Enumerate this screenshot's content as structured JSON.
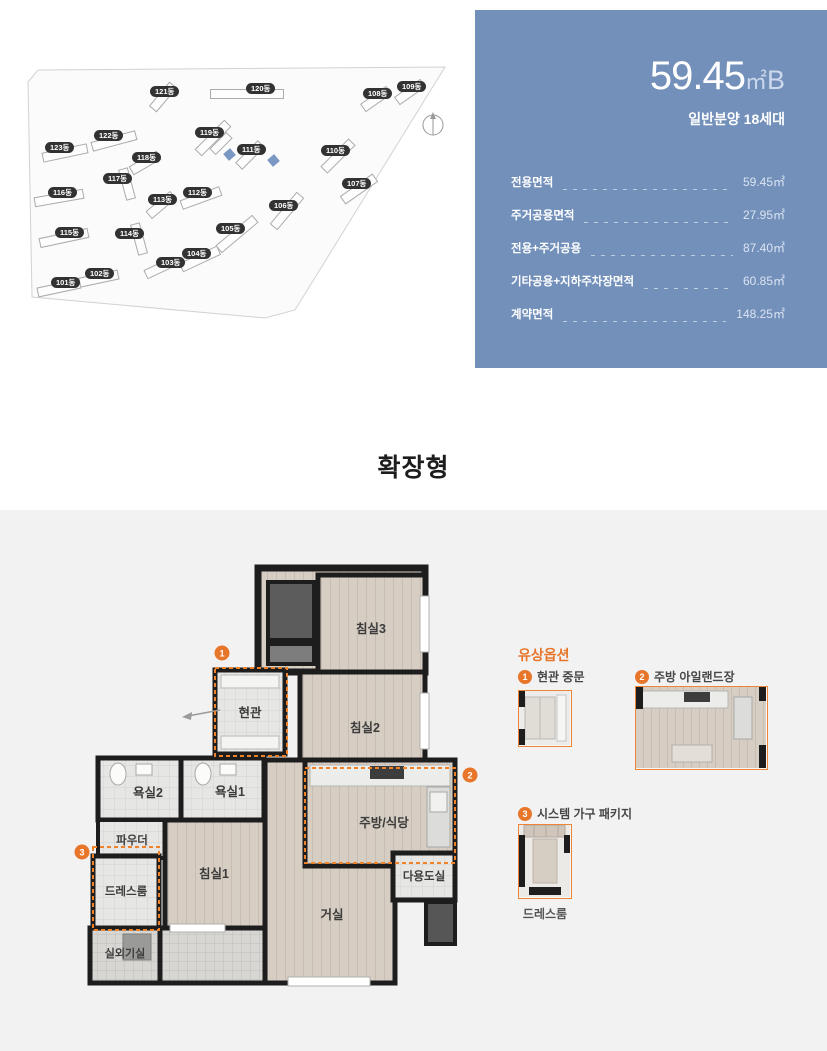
{
  "site_map": {
    "buildings": [
      {
        "label": "121동"
      },
      {
        "label": "120동"
      },
      {
        "label": "108동"
      },
      {
        "label": "109동"
      },
      {
        "label": "123동"
      },
      {
        "label": "122동"
      },
      {
        "label": "119동"
      },
      {
        "label": "111동"
      },
      {
        "label": "110동"
      },
      {
        "label": "107동"
      },
      {
        "label": "118동"
      },
      {
        "label": "117동"
      },
      {
        "label": "116동"
      },
      {
        "label": "113동"
      },
      {
        "label": "112동"
      },
      {
        "label": "106동"
      },
      {
        "label": "115동"
      },
      {
        "label": "114동"
      },
      {
        "label": "105동"
      },
      {
        "label": "104동"
      },
      {
        "label": "103동"
      },
      {
        "label": "102동"
      },
      {
        "label": "101동"
      }
    ],
    "highlight_color": "#7b97c4"
  },
  "info_panel": {
    "title_value": "59.45",
    "title_unit": "㎡",
    "title_suffix": "B",
    "subtitle": "일반분양 18세대",
    "accent_color": "#7290ba",
    "rows": [
      {
        "label": "전용면적",
        "value": "59.45㎡"
      },
      {
        "label": "주거공용면적",
        "value": "27.95㎡"
      },
      {
        "label": "전용+주거공용",
        "value": "87.40㎡"
      },
      {
        "label": "기타공용+지하주차장면적",
        "value": "60.85㎡"
      },
      {
        "label": "계약면적",
        "value": "148.25㎡"
      }
    ]
  },
  "section_title": "확장형",
  "floor_plan": {
    "accent_color": "#e8762a",
    "rooms": [
      {
        "label": "침실3"
      },
      {
        "label": "침실2"
      },
      {
        "label": "현관"
      },
      {
        "label": "욕실2"
      },
      {
        "label": "욕실1"
      },
      {
        "label": "파우더"
      },
      {
        "label": "드레스룸"
      },
      {
        "label": "침실1"
      },
      {
        "label": "실외기실"
      },
      {
        "label": "주방/식당"
      },
      {
        "label": "다용도실"
      },
      {
        "label": "거실"
      }
    ],
    "markers": {
      "m1": "1",
      "m2": "2",
      "m3": "3"
    }
  },
  "options_panel": {
    "heading": "유상옵션",
    "items": [
      {
        "num": "1",
        "label": "현관 중문"
      },
      {
        "num": "2",
        "label": "주방 아일랜드장"
      },
      {
        "num": "3",
        "label": "시스템 가구 패키지",
        "caption": "드레스룸"
      }
    ]
  }
}
